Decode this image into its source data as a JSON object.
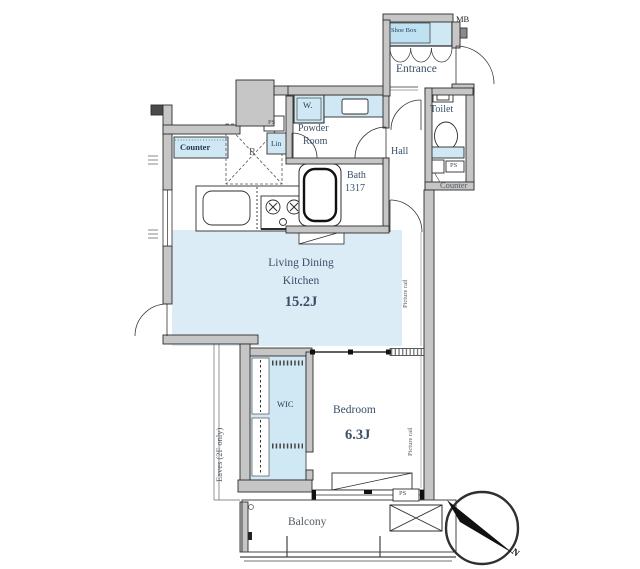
{
  "palette": {
    "wall_fill": "#c6c6c6",
    "wall_stroke": "#2d2d2d",
    "ldk_fill": "#dcecf7",
    "fixture_fill": "#cfe8f4",
    "label_color": "#3a4f66"
  },
  "rooms": {
    "living": {
      "line1": "Living Dining",
      "line2": "Kitchen",
      "size": "15.2J"
    },
    "bedroom": {
      "label": "Bedroom",
      "size": "6.3J"
    },
    "entrance": {
      "label": "Entrance"
    },
    "hall": {
      "label": "Hall"
    },
    "toilet": {
      "label": "Toilet"
    },
    "powder": {
      "line1": "Powder",
      "line2": "Room"
    },
    "bath": {
      "label": "Bath",
      "size": "1317"
    },
    "wic": {
      "label": "WIC"
    },
    "balcony": {
      "label": "Balcony"
    }
  },
  "labels": {
    "shoe_box": "Shoe Box",
    "mb": "MB",
    "counter_kitchen": "Counter",
    "counter_toilet": "Counter",
    "fridge": "R",
    "linen": "Lin",
    "washer": "W.",
    "ps": "PS",
    "picture_rail": "Picture rail",
    "eaves": "Eaves (2F only)",
    "north": "N"
  }
}
